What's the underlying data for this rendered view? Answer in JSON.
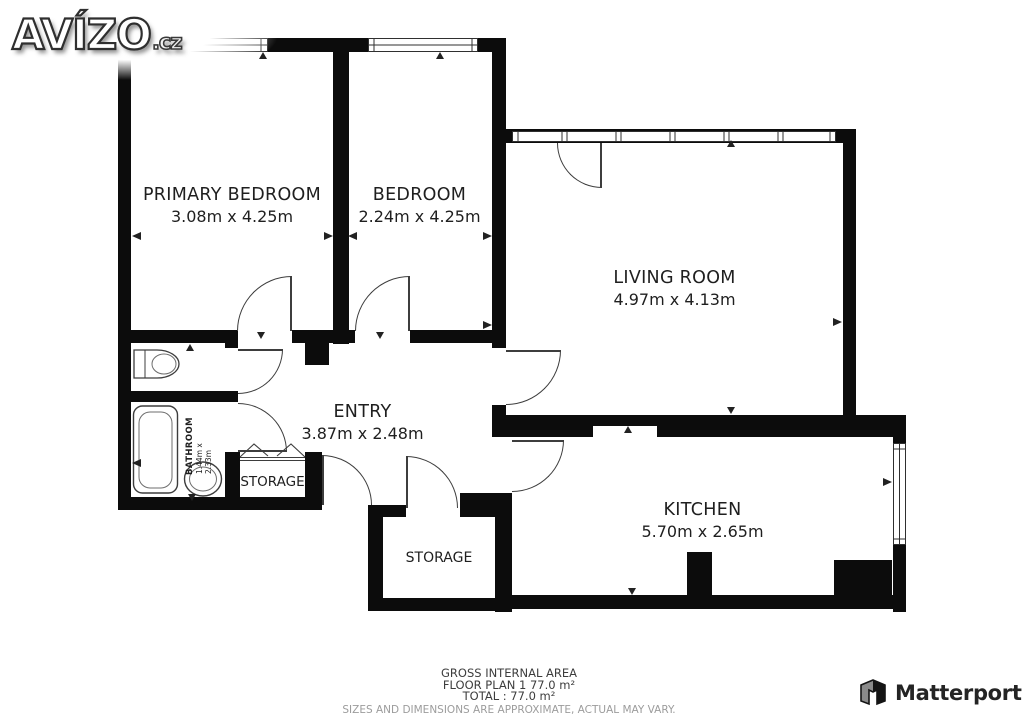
{
  "branding": {
    "site": "AVÍZO",
    "site_tld": ".cz",
    "vendor": "Matterport"
  },
  "colors": {
    "wall": "#0c0c0c",
    "fixture_line": "#3d3d3d",
    "text": "#1f1f1f",
    "muted_text": "#9c9c9c"
  },
  "rooms": {
    "primary_bedroom": {
      "name": "PRIMARY BEDROOM",
      "dims": "3.08m x 4.25m"
    },
    "bedroom": {
      "name": "BEDROOM",
      "dims": "2.24m x 4.25m"
    },
    "living_room": {
      "name": "LIVING ROOM",
      "dims": "4.97m x 4.13m"
    },
    "entry": {
      "name": "ENTRY",
      "dims": "3.87m x 2.48m"
    },
    "kitchen": {
      "name": "KITCHEN",
      "dims": "5.70m x 2.65m"
    },
    "bathroom": {
      "name": "BATHROOM",
      "dims": "1.44m x 2.33m"
    },
    "storage_hall": {
      "name": "STORAGE"
    },
    "storage_lower": {
      "name": "STORAGE"
    }
  },
  "footer": {
    "area_title": "GROSS INTERNAL AREA",
    "floor_line": "FLOOR PLAN 1 77.0 m²",
    "total_line": "TOTAL :  77.0 m²",
    "disclaimer": "SIZES AND DIMENSIONS ARE APPROXIMATE, ACTUAL MAY VARY."
  }
}
